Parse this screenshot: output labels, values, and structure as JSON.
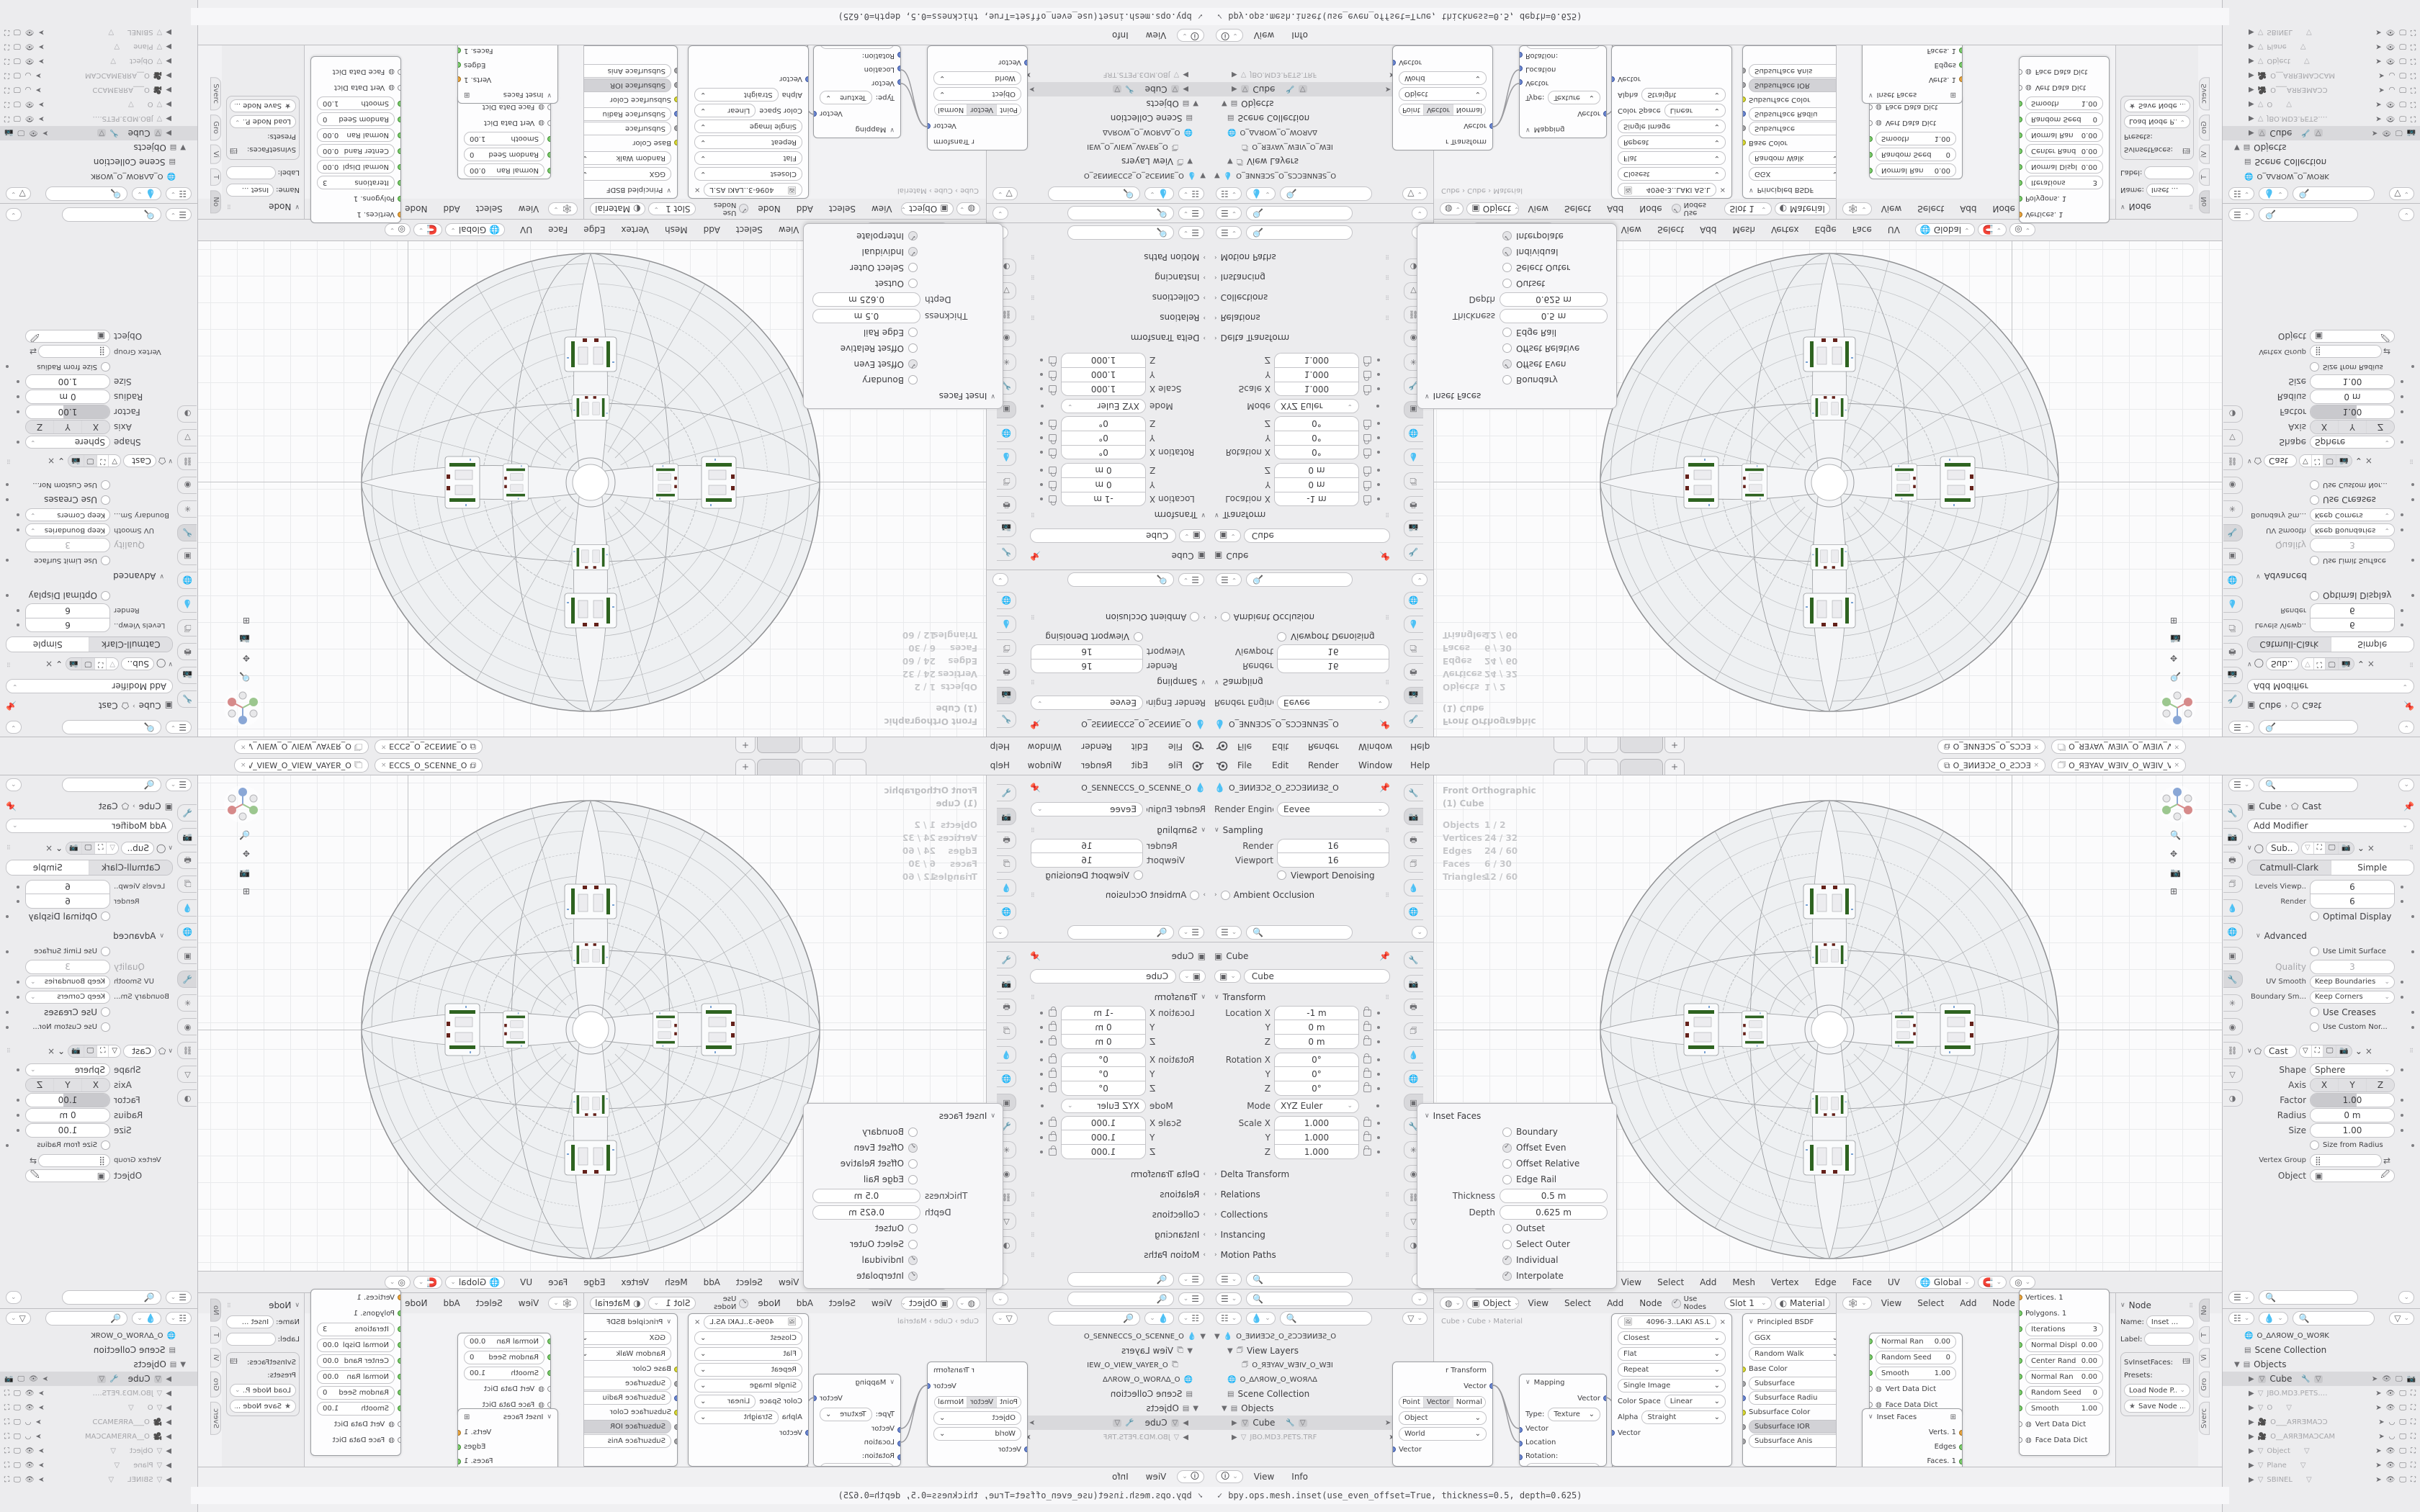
{
  "topbar": {
    "menus": [
      "File",
      "Edit",
      "Render",
      "Window",
      "Help"
    ],
    "tab_plus": "+",
    "scene_name": "O_ƎИИƎƆƧ_O_ƧƆƆƎИИƎƧ_O",
    "viewlayer_name": "O_ЯƎYAV_WƎIV_O_WƎIV_VAYƎЯ_O"
  },
  "render_props": {
    "breadcrumb": "O_ƎИИƎƆƧ_O_ƧƆƆƎИИƎƧ_O",
    "engine_label": "Render Engine",
    "engine_value": "Eevee",
    "sampling_title": "Sampling",
    "render_label": "Render",
    "render_value": "16",
    "viewport_label": "Viewport",
    "viewport_value": "16",
    "denoise_label": "Viewport Denoising",
    "ao_label": "Ambient Occlusion"
  },
  "object_props": {
    "breadcrumb": "Cube",
    "name_value": "Cube",
    "transform_title": "Transform",
    "loc_x_label": "Location X",
    "loc_x": "-1 m",
    "loc_y_label": "Y",
    "loc_y": "0 m",
    "loc_z_label": "Z",
    "loc_z": "0 m",
    "rot_x_label": "Rotation X",
    "rot_x": "0°",
    "rot_y_label": "Y",
    "rot_y": "0°",
    "rot_z_label": "Z",
    "rot_z": "0°",
    "mode_label": "Mode",
    "mode_value": "XYZ Euler",
    "scale_x_label": "Scale X",
    "scale_x": "1.000",
    "scale_y_label": "Y",
    "scale_y": "1.000",
    "scale_z_label": "Z",
    "scale_z": "1.000",
    "collapsed": [
      "Delta Transform",
      "Relations",
      "Collections",
      "Instancing",
      "Motion Paths",
      "Visibility"
    ]
  },
  "outliner_left": {
    "rows": [
      {
        "label": "O_ƎИИƎƆƧ_O_ƧƆƆƎИИƎƧ_O"
      },
      {
        "label": "View Layers"
      },
      {
        "label": "O_ЯƎYAV_WƎIV_O_WƎI"
      },
      {
        "label": "O_ΔΛЯOW_O_WOЯΛΔ"
      },
      {
        "label": "Scene Collection"
      },
      {
        "label": "Objects"
      },
      {
        "label": "Cube"
      },
      {
        "label": "JBO.MD3.PETS.TRF"
      }
    ]
  },
  "viewport": {
    "view_label": "Front Orthographic",
    "active_label": "(1) Cube",
    "stats": [
      {
        "k": "Objects",
        "v": "1 / 2"
      },
      {
        "k": "Vertices",
        "v": "24 / 32"
      },
      {
        "k": "Edges",
        "v": "24 / 60"
      },
      {
        "k": "Faces",
        "v": "6 / 30"
      },
      {
        "k": "Triangles",
        "v": "12 / 60"
      }
    ],
    "header": {
      "mode": "Edit Mode",
      "menus": [
        "View",
        "Select",
        "Add",
        "Mesh",
        "Vertex",
        "Edge",
        "Face",
        "UV"
      ],
      "orientation": "Global"
    }
  },
  "inset_panel": {
    "title": "Inset Faces",
    "boundary": "Boundary",
    "offset_even": "Offset Even",
    "offset_relative": "Offset Relative",
    "edge_rail": "Edge Rail",
    "thickness_label": "Thickness",
    "thickness_value": "0.5 m",
    "depth_label": "Depth",
    "depth_value": "0.625 m",
    "outset": "Outset",
    "select_outer": "Select Outer",
    "individual": "Individual",
    "interpolate": "Interpolate"
  },
  "shader_editor": {
    "mode": "Object",
    "menus": [
      "View",
      "Select",
      "Add",
      "Node"
    ],
    "use_nodes": "Use Nodes",
    "slot": "Slot 1",
    "material": "Material",
    "breadcrumb": "Cube  ›  Cube  ›  Material",
    "vector_transform": {
      "title": "r Transform",
      "out": "Vector",
      "seg": [
        "Point",
        "Vector",
        "Normal"
      ],
      "space_from": "Object",
      "space_to": "World",
      "in": "Vector"
    },
    "mapping": {
      "title": "Mapping",
      "out": "Vector",
      "type_label": "Type:",
      "type_value": "Texture",
      "in1": "Vector",
      "in2": "Location",
      "in3": "Rotation:",
      "rot_x": "X",
      "rot_x_v": "0°"
    },
    "image_texture": {
      "datablock": "4096-3..LAKI AS.L",
      "rows": [
        "Closest",
        "Flat",
        "Repeat",
        "Single Image"
      ],
      "colorspace_label": "Color Space",
      "colorspace": "Linear",
      "alpha_label": "Alpha",
      "alpha": "Straight",
      "in": "Vector"
    },
    "principled": {
      "title": "Principled BSDF",
      "ggx": "GGX",
      "walk": "Random Walk",
      "inputs": [
        "Base Color",
        "Subsurface",
        "Subsurface Radiu",
        "Subsurface Color",
        "Subsurface IOR",
        "Subsurface Anis"
      ]
    },
    "sv_small": {
      "rows": [
        {
          "k": "Normal Ran",
          "v": "0.00"
        },
        {
          "k": "Random Seed",
          "v": "0"
        },
        {
          "k": "Smooth",
          "v": "1.00"
        }
      ],
      "dicts": [
        "Vert Data Dict",
        "Face Data Dict"
      ]
    },
    "inset_node": {
      "title": "Inset Faces",
      "outs": [
        "Verts. 1",
        "Edges",
        "Faces. 1",
        "Face data"
      ]
    }
  },
  "sverchok_editor": {
    "menus": [
      "View",
      "Select",
      "Add",
      "Node"
    ],
    "big_node": {
      "rows_plain": [
        "Vertices. 1",
        "Polygons. 1"
      ],
      "rows_val": [
        {
          "k": "Iterations",
          "v": "3"
        },
        {
          "k": "Normal Displ",
          "v": "0.00"
        },
        {
          "k": "Center Rand",
          "v": "0.00"
        },
        {
          "k": "Normal Ran",
          "v": "0.00"
        },
        {
          "k": "Random Seed",
          "v": "0"
        },
        {
          "k": "Smooth",
          "v": "1.00"
        }
      ],
      "dicts": [
        "Vert Data Dict",
        "Face Data Dict"
      ]
    },
    "npanel": {
      "title": "Node",
      "name_label": "Name:",
      "name_value": "Inset ...",
      "label_label": "Label:",
      "idname": "SvInsetFaces:",
      "presets_label": "Presets:",
      "load_btn": "Load Node P...",
      "save_btn": "Save Node ..."
    },
    "tabs": [
      "No",
      "T",
      "Vi",
      "Gro",
      "Sverc"
    ]
  },
  "modifier_props": {
    "breadcrumb_obj": "Cube",
    "breadcrumb_mod": "Cast",
    "add_modifier": "Add Modifier",
    "subsurf": {
      "name": "Sub..",
      "type_a": "Catmull-Clark",
      "type_b": "Simple",
      "levels_label": "Levels Viewp..",
      "levels": "6",
      "render_label": "Render",
      "render": "6",
      "optimal": "Optimal Display",
      "advanced": "Advanced",
      "limit": "Use Limit Surface",
      "quality_label": "Quality",
      "quality": "3",
      "uv_label": "UV Smooth",
      "uv_value": "Keep Boundaries",
      "bs_label": "Boundary Sm...",
      "bs_value": "Keep Corners",
      "creases": "Use Creases",
      "custom_nor": "Use Custom Nor..."
    },
    "cast": {
      "name": "Cast",
      "shape_label": "Shape",
      "shape_value": "Sphere",
      "axis_label": "Axis",
      "axis": [
        "X",
        "Y",
        "Z"
      ],
      "factor_label": "Factor",
      "factor": "1.00",
      "radius_label": "Radius",
      "radius": "0 m",
      "size_label": "Size",
      "size": "1.00",
      "size_from_radius": "Size from Radius",
      "vgroup_label": "Vertex Group",
      "object_label": "Object"
    }
  },
  "outliner_right": {
    "rows": [
      {
        "label": "O_ΔΛЯOW_O_WOЯK"
      },
      {
        "label": "Scene Collection"
      },
      {
        "label": "Objects"
      },
      {
        "label": "Cube"
      },
      {
        "label": "JBO.MD3.PETS.TRF"
      },
      {
        "label": "O"
      },
      {
        "label": "O___AЯRƎMAƆƆ"
      },
      {
        "label": "O__AЯRƎMAƆCAM"
      },
      {
        "label": "Object"
      },
      {
        "label": "Plane"
      },
      {
        "label": "SBINEL"
      }
    ]
  },
  "info_editor": {
    "menus": [
      "View",
      "Info"
    ],
    "log": "bpy.ops.mesh.inset(use_even_offset=True, thickness=0.5, depth=0.625)"
  }
}
